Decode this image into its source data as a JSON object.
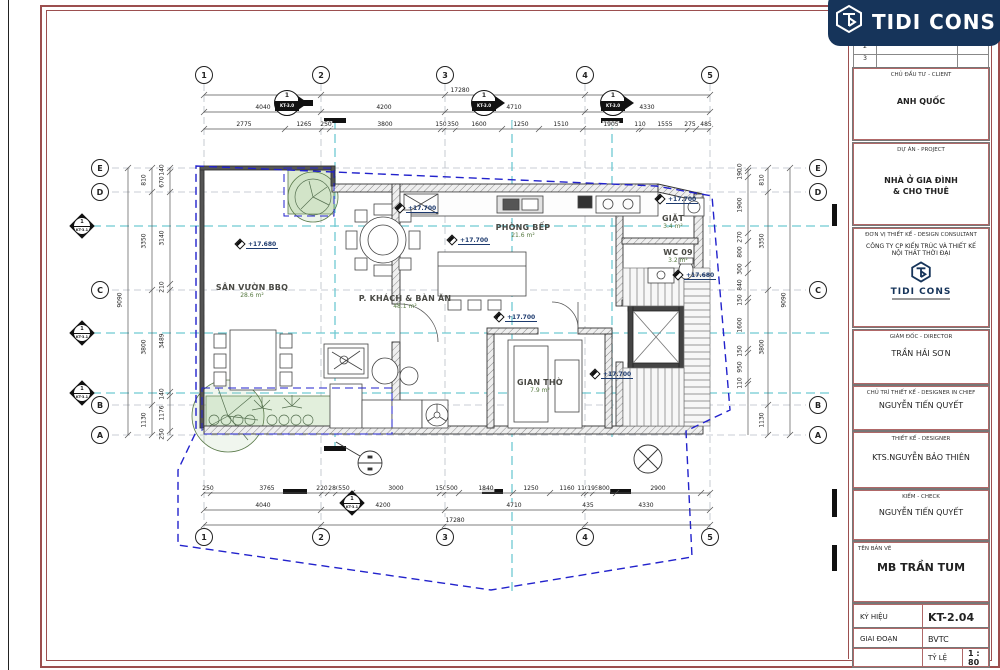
{
  "sheet": {
    "logo": {
      "text": "TIDI CONS"
    },
    "title_block": {
      "revision_rows": [
        "2",
        "3"
      ],
      "client": {
        "label": "CHỦ ĐẦU TƯ - CLIENT",
        "value": "ANH QUỐC"
      },
      "project": {
        "label": "DỰ ÁN - PROJECT",
        "line1": "NHÀ Ở GIA ĐÌNH",
        "line2": "& CHO THUÊ"
      },
      "consultant": {
        "label": "ĐƠN VỊ THIẾT KẾ - DESIGN CONSULTANT",
        "company_line1": "CÔNG TY CP KIẾN TRÚC VÀ THIẾT KẾ",
        "company_line2": "NỘI THẤT THỜI ĐẠI",
        "logo_text": "TIDI CONS"
      },
      "director": {
        "label": "GIÁM ĐỐC - DIRECTOR",
        "value": "TRẦN HẢI SƠN"
      },
      "chief": {
        "label": "CHỦ TRÌ THIẾT KẾ - DESIGNER IN CHIEF",
        "value": "NGUYỄN TIẾN QUYẾT"
      },
      "designer": {
        "label": "THIẾT KẾ - DESIGNER",
        "value": "KTS.NGUYỄN BẢO THIÊN"
      },
      "checker": {
        "label": "KIỂM - CHECK",
        "value": "NGUYỄN TIẾN QUYẾT"
      },
      "drawing": {
        "label": "TÊN BẢN VẼ",
        "value": "MB TRẦN TUM"
      },
      "code": {
        "label": "KÝ HIỆU",
        "value": "KT-2.04"
      },
      "stage": {
        "label": "GIAI ĐOẠN",
        "value": "BVTC"
      },
      "scale": {
        "label": "TỶ LỆ",
        "value": "1 : 80"
      }
    }
  },
  "plan": {
    "grid": {
      "cols": [
        "1",
        "2",
        "3",
        "4",
        "5"
      ],
      "rows": [
        "E",
        "D",
        "C",
        "B",
        "A"
      ]
    },
    "dims": {
      "overall_h": "17280",
      "overall_v": "9090",
      "top_spans": [
        "4040",
        "4200",
        "4710",
        "4330"
      ],
      "top_detail": [
        "2775",
        "1265",
        "250",
        "3800",
        "150",
        "350",
        "1600",
        "1250",
        "1510",
        "1905",
        "110",
        "1555",
        "275",
        "485"
      ],
      "bottom_spans": [
        "4040",
        "4200",
        "4710",
        "4330"
      ],
      "bottom_extra": "435",
      "bottom_detail": [
        "250",
        "3765",
        "220",
        "280",
        "550",
        "3000",
        "150",
        "500",
        "1840",
        "1250",
        "1160",
        "110",
        "195",
        "800",
        "2900"
      ],
      "left_spans": [
        "810",
        "3350",
        "3800",
        "1130"
      ],
      "left_detail": [
        "140",
        "670",
        "3140",
        "210",
        "3489",
        "140",
        "1176",
        "250"
      ],
      "right_spans": [
        "810",
        "3350",
        "3800",
        "1130"
      ],
      "right_detail": [
        "110",
        "190",
        "1900",
        "270",
        "800",
        "300",
        "840",
        "150",
        "1600",
        "150",
        "950",
        "110"
      ]
    },
    "rooms": [
      {
        "name": "SÂN VƯỜN BBQ",
        "area": "28.6 m²"
      },
      {
        "name": "P. KHÁCH & BÀN ĂN",
        "area": "48.1 m²"
      },
      {
        "name": "PHÒNG BẾP",
        "area": "21.6 m²"
      },
      {
        "name": "GIAN THỜ",
        "area": "7.9 m²"
      },
      {
        "name": "GIẶT",
        "area": "3.4 m²"
      },
      {
        "name": "WC 09",
        "area": "3.2 m²"
      }
    ],
    "level_markers": [
      "+17.680",
      "+17.700",
      "+17.700",
      "+17.700",
      "+17.680",
      "+17.700",
      "+17.700"
    ],
    "section_markers": {
      "number": "1",
      "top": [
        "KT-3.0",
        "KT-3.0",
        "KT-3.0"
      ],
      "left": [
        "KT-3.1",
        "KT-3.1",
        "KT-3.1"
      ],
      "bottom": [
        "KT-3.1"
      ]
    },
    "colors": {
      "grid_gray": "#b9bfc6",
      "section_teal": "#6fc9d2",
      "boundary_blue": "#2222cc",
      "frame_red": "#9c4f4f",
      "banner_navy": "#16345a",
      "plant_green": "#dcead2"
    }
  }
}
